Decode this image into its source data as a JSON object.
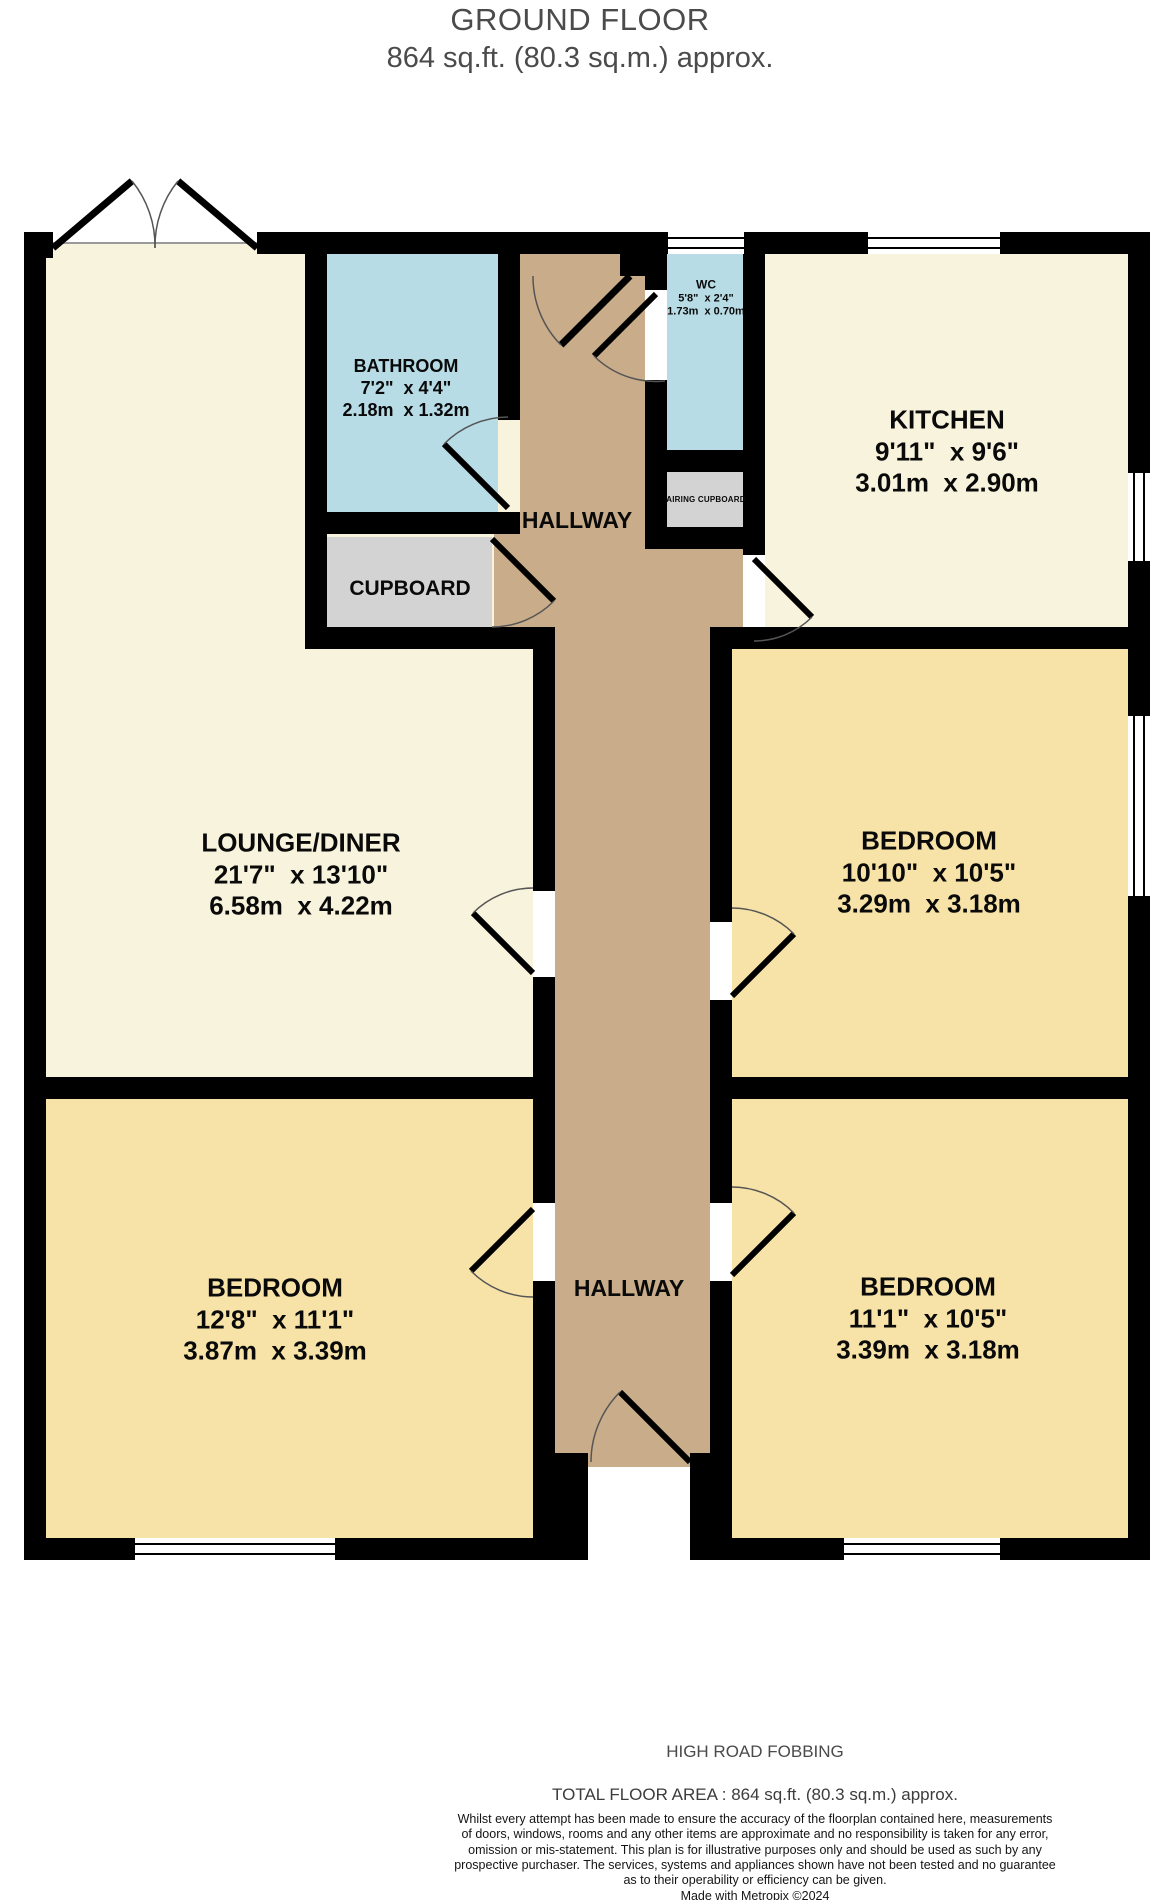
{
  "title": {
    "line1": "GROUND FLOOR",
    "line2": "864 sq.ft. (80.3 sq.m.) approx."
  },
  "rooms": {
    "bathroom": {
      "name": "BATHROOM",
      "imperial": "7'2\"  x 4'4\"",
      "metric": "2.18m  x 1.32m"
    },
    "wc": {
      "name": "WC",
      "imperial": "5'8\"  x 2'4\"",
      "metric": "1.73m  x 0.70m"
    },
    "kitchen": {
      "name": "KITCHEN",
      "imperial": "9'11\"  x 9'6\"",
      "metric": "3.01m  x 2.90m"
    },
    "hallway_top": {
      "name": "HALLWAY"
    },
    "airing_cupboard": {
      "name": "AIRING CUPBOARD"
    },
    "cupboard": {
      "name": "CUPBOARD"
    },
    "lounge_diner": {
      "name": "LOUNGE/DINER",
      "imperial": "21'7\"  x 13'10\"",
      "metric": "6.58m  x 4.22m"
    },
    "bedroom_right": {
      "name": "BEDROOM",
      "imperial": "10'10\"  x 10'5\"",
      "metric": "3.29m  x 3.18m"
    },
    "hallway_bottom": {
      "name": "HALLWAY"
    },
    "bedroom_left": {
      "name": "BEDROOM",
      "imperial": "12'8\"  x 11'1\"",
      "metric": "3.87m  x 3.39m"
    },
    "bedroom_bottom_right": {
      "name": "BEDROOM",
      "imperial": "11'1\"  x 10'5\"",
      "metric": "3.39m  x 3.18m"
    }
  },
  "footer": {
    "address": "HIGH ROAD FOBBING",
    "total_area": "TOTAL FLOOR AREA : 864 sq.ft. (80.3 sq.m.) approx.",
    "disclaimer_lines": [
      "Whilst every attempt has been made to ensure the accuracy of the floorplan contained here, measurements",
      "of doors, windows, rooms and any other items are approximate and no responsibility is taken for any error,",
      "omission or mis-statement. This plan is for illustrative purposes only and should be used as such by any",
      "prospective purchaser. The services, systems and appliances shown have not been tested and no guarantee",
      "as to their operability or efficiency can be given."
    ],
    "credit": "Made with Metropix ©2024"
  },
  "colors": {
    "room_cream": "#f8f3dc",
    "room_yellow": "#f7e3a7",
    "room_blue": "#b7dce6",
    "room_tan": "#c9ac89",
    "room_grey": "#d3d3d3",
    "wall": "#000000",
    "door_arc": "#555555",
    "threshold": "#9a9a9a"
  }
}
